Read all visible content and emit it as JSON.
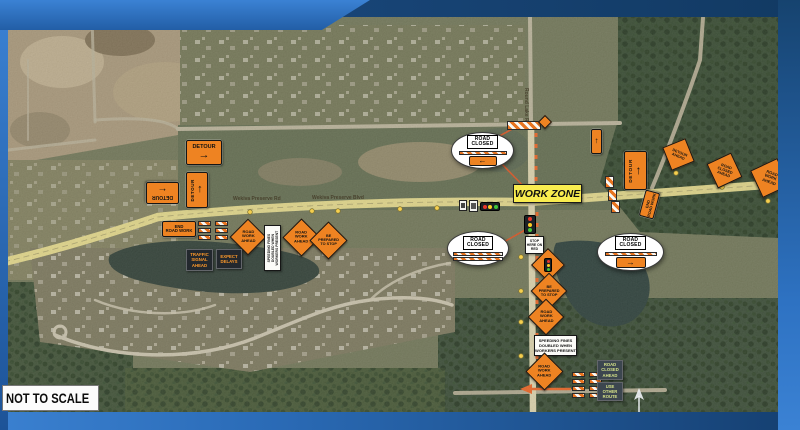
{
  "brand": {
    "frame_blue": "#2e72c2",
    "frame_blue_dark": "#123a66",
    "sign_orange": "#ee8322",
    "work_zone_yellow": "#f8ec4f"
  },
  "labels": {
    "not_to_scale": "NOT TO SCALE",
    "work_zone": "WORK ZONE",
    "north": "N",
    "road_main_a": "Wekiva Preserve Rd",
    "road_main_b": "Wekiva Preserve Blvd",
    "road_vertical": "Round Lake Rd"
  },
  "detour": {
    "label": "DETOUR",
    "arrow_right": "→",
    "arrow_left": "←",
    "arrow_up": "↑"
  },
  "callouts": {
    "c1": {
      "line1": "ROAD",
      "line2": "CLOSED"
    },
    "c2": {
      "line1": "ROAD",
      "line2": "CLOSED"
    },
    "c3": {
      "line1": "ROAD",
      "line2": "CLOSED"
    }
  },
  "diamonds": {
    "west1": [
      "ROAD",
      "WORK",
      "AHEAD"
    ],
    "west2": [
      "ROAD",
      "WORK",
      "AHEAD"
    ],
    "west3": [
      "BE",
      "PREPARED",
      "TO STOP"
    ],
    "south2": [
      "BE",
      "PREPARED",
      "TO STOP"
    ],
    "south3": [
      "ROAD",
      "WORK",
      "AHEAD"
    ],
    "south4": [
      "ROAD",
      "WORK",
      "AHEAD"
    ],
    "east1": [
      "DETOUR",
      "AHEAD"
    ],
    "east2": [
      "ROAD",
      "CLOSED",
      "AHEAD"
    ],
    "east3": [
      "ROAD",
      "WORK",
      "AHEAD"
    ]
  },
  "rects": {
    "end_west": [
      "END",
      "ROAD WORK"
    ],
    "end_east": [
      "END",
      "ROAD WORK"
    ],
    "speed_v": [
      "SPEEDING FINES",
      "DOUBLED WHEN",
      "WORKERS PRESENT"
    ],
    "speed_h": [
      "SPEEDING FINES",
      "DOUBLED WHEN",
      "WORKERS PRESENT"
    ],
    "stop_here": [
      "STOP",
      "HERE ON",
      "RED"
    ]
  },
  "boards": {
    "traffic_signal": [
      "TRAFFIC",
      "SIGNAL",
      "AHEAD"
    ],
    "expect_delays": [
      "EXPECT",
      "DELAYS"
    ],
    "road_closed": [
      "ROAD",
      "CLOSED",
      "AHEAD"
    ],
    "use_route": [
      "USE",
      "OTHER",
      "ROUTE"
    ]
  }
}
